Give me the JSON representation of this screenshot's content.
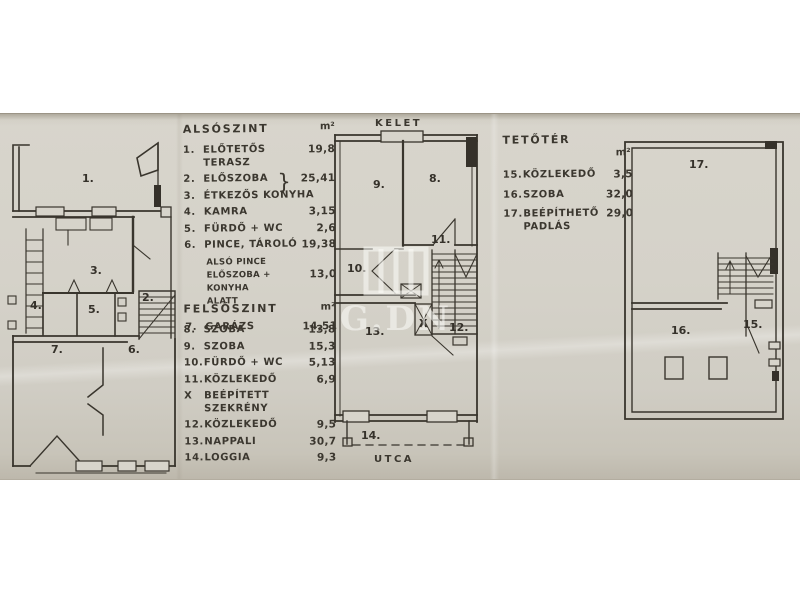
{
  "compass": {
    "east": "KELET",
    "street": "UTCA"
  },
  "watermark": {
    "text": "G.DN"
  },
  "colors": {
    "paper": "#d5d2c9",
    "ink": "#3b372f"
  },
  "lists": {
    "alsoszint": {
      "title": "ALSÓSZINT",
      "unit": "m²",
      "items": [
        {
          "num": "1.",
          "label": "ELŐTETŐS TERASZ",
          "value": "19,8"
        },
        {
          "num": "2.",
          "label": "ELŐSZOBA",
          "value": "25,41",
          "brace": "}"
        },
        {
          "num": "3.",
          "label": "ÉTKEZŐS KONYHA",
          "value": ""
        },
        {
          "num": "4.",
          "label": "KAMRA",
          "value": "3,15"
        },
        {
          "num": "5.",
          "label": "FÜRDŐ + WC",
          "value": "2,6"
        },
        {
          "num": "6.",
          "label": "PINCE, TÁROLÓ",
          "value": "19,38"
        },
        {
          "num": "",
          "label": "ALSÓ PINCE",
          "value": "",
          "cls": "sub"
        },
        {
          "num": "",
          "label": "ELŐSZOBA + KONYHA",
          "value": "13,0",
          "cls": "sub"
        },
        {
          "num": "",
          "label": "ALATT",
          "value": "",
          "cls": "sub"
        },
        {
          "num": "7.",
          "label": "GARÁZS",
          "value": "14,51",
          "cls": "gap"
        }
      ]
    },
    "felsoszint": {
      "title": "FELSŐSZINT",
      "unit": "m²",
      "items": [
        {
          "num": "8.",
          "label": "SZOBA",
          "value": "13,8"
        },
        {
          "num": "9.",
          "label": "SZOBA",
          "value": "15,3"
        },
        {
          "num": "10.",
          "label": "FÜRDŐ + WC",
          "value": "5,13"
        },
        {
          "num": "11.",
          "label": "KÖZLEKEDŐ",
          "value": "6,9"
        },
        {
          "num": "X",
          "label": "BEÉPÍTETT SZEKRÉNY",
          "value": ""
        },
        {
          "num": "12.",
          "label": "KÖZLEKEDŐ",
          "value": "9,5"
        },
        {
          "num": "13.",
          "label": "NAPPALI",
          "value": "30,7"
        },
        {
          "num": "14.",
          "label": "LOGGIA",
          "value": "9,3"
        }
      ]
    },
    "tetoter": {
      "title": "TETŐTÉR",
      "unit": "m²",
      "items": [
        {
          "num": "15.",
          "label": "KÖZLEKEDŐ",
          "value": "3,5"
        },
        {
          "num": "16.",
          "label": "SZOBA",
          "value": "32,0"
        },
        {
          "num": "17.",
          "label": "BEÉPÍTHETŐ",
          "label2": "PADLÁS",
          "value": "29,0"
        }
      ]
    }
  },
  "plans": {
    "p1": {
      "labels": [
        "1.",
        "3.",
        "2.",
        "4.",
        "5.",
        "7.",
        "6."
      ]
    },
    "p2": {
      "labels": [
        "9.",
        "8.",
        "11.",
        "10.",
        "X",
        "12.",
        "13.",
        "14."
      ]
    },
    "p3": {
      "labels": [
        "17.",
        "16.",
        "15."
      ]
    }
  }
}
